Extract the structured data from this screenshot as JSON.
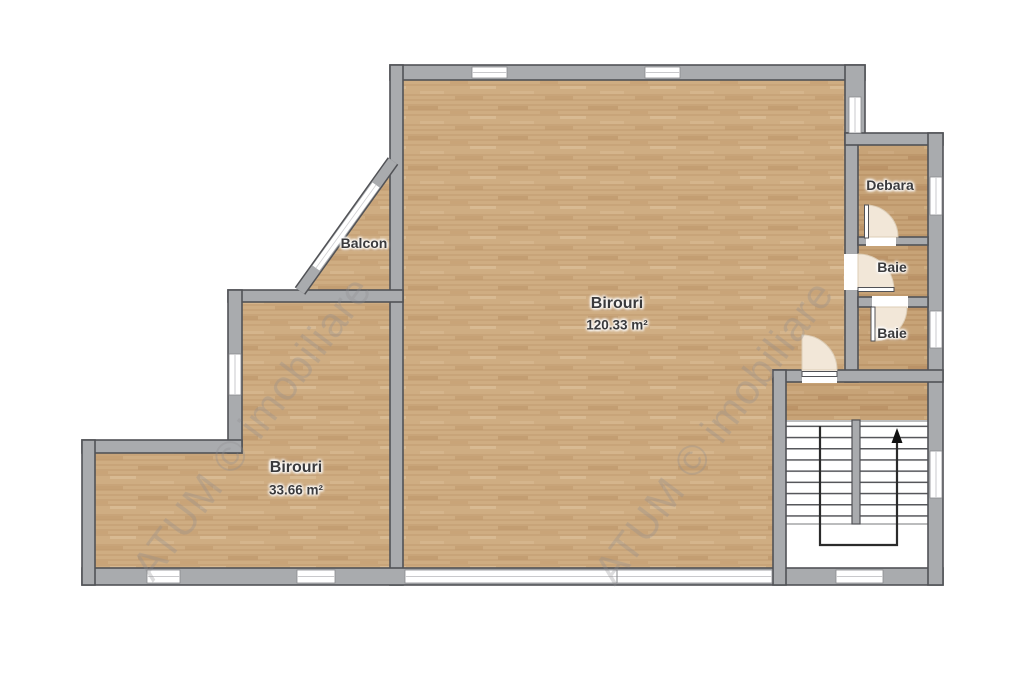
{
  "plan": {
    "type": "floor-plan",
    "watermark": {
      "text": "ATUM © imobiliare"
    },
    "rooms": {
      "birouri_main": {
        "label": "Birouri",
        "area": "120.33 m²"
      },
      "birouri_small": {
        "label": "Birouri",
        "area": "33.66 m²"
      },
      "balcon": {
        "label": "Balcon"
      },
      "debara": {
        "label": "Debara"
      },
      "baie_upper": {
        "label": "Baie"
      },
      "baie_lower": {
        "label": "Baie"
      }
    },
    "icons": {
      "stairs_direction_arrow": "up-arrow"
    },
    "colors": {
      "wall": "#a9abae",
      "wall_outline": "#515256",
      "floor_wood": "#cfad82",
      "floor_wood_dark": "#c7a377",
      "door_swing": "#f2e7d8",
      "stairs_line": "#2b2b2b",
      "background": "#ffffff"
    }
  }
}
